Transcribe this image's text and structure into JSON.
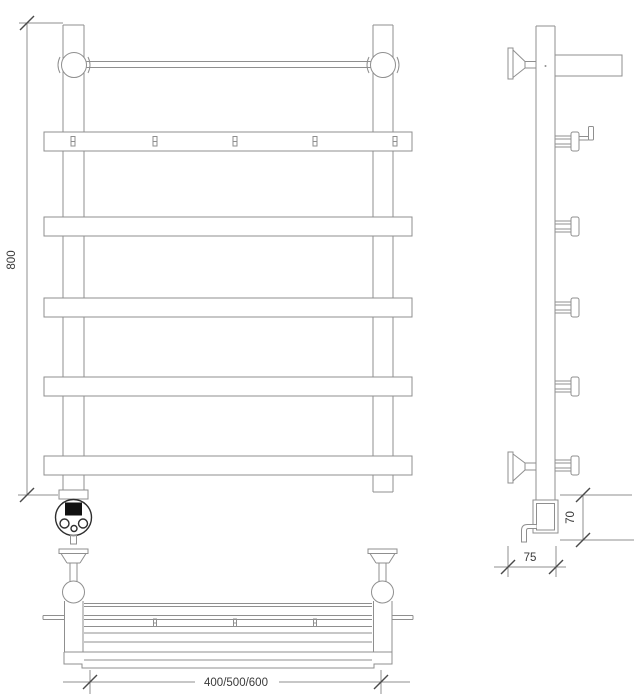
{
  "drawing": {
    "front_view": {
      "height_label": "800"
    },
    "bottom_view": {
      "width_label": "400/500/600"
    },
    "side_view": {
      "heater_height_label": "70",
      "depth_label": "75"
    },
    "colors": {
      "line": "#8f8f8f",
      "tick": "#4a4a4a",
      "dark": "#2e2e2e",
      "text": "#3a3a3a",
      "display": "#111111",
      "bg": "#ffffff"
    }
  }
}
